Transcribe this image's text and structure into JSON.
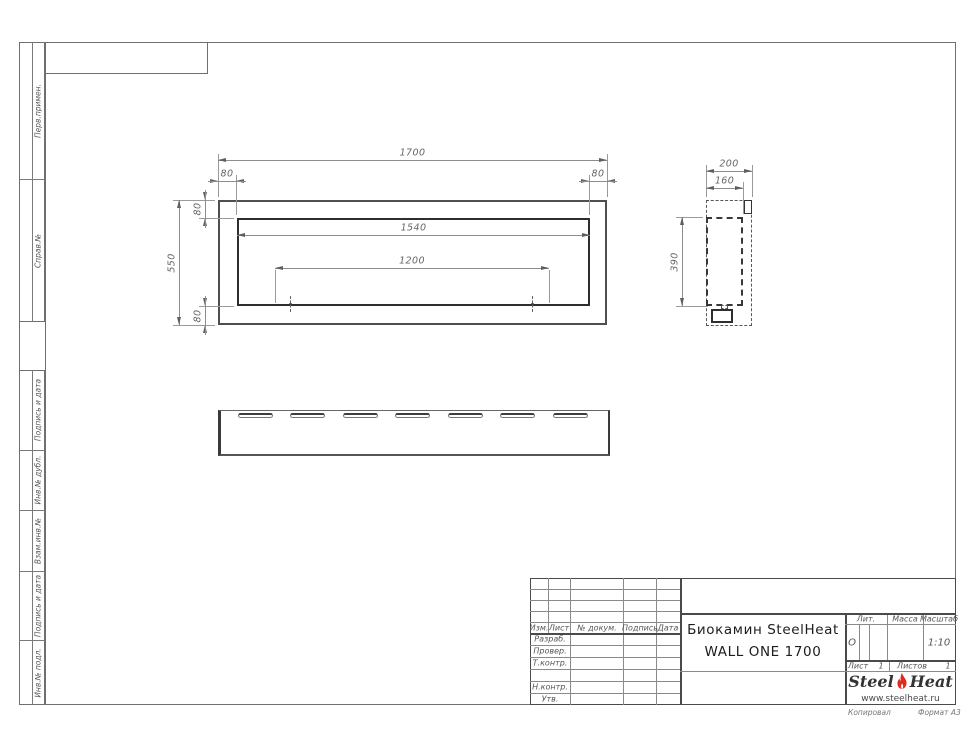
{
  "document": {
    "title_line1": "Биокамин SteelHeat",
    "title_line2": "WALL ONE 1700"
  },
  "stamp": {
    "header": {
      "izm": "Изм.",
      "list": "Лист",
      "doc": "№ докум.",
      "sign": "Подпись",
      "date": "Дата"
    },
    "rows": {
      "razrab": "Разраб.",
      "prover": "Провер.",
      "tkontr": "Т.контр.",
      "nkontr": "Н.контр.",
      "utv": "Утв."
    },
    "right": {
      "lit_label": "Лит.",
      "massa_label": "Масса",
      "scale_label": "Масштаб",
      "lit_value": "О",
      "scale_value": "1:10",
      "sheet_label": "Лист",
      "sheet_value": "1",
      "sheets_label": "Листов",
      "sheets_value": "1"
    }
  },
  "logo": {
    "steel": "Steel",
    "heat": "Heat",
    "site": "www.steelheat.ru",
    "flame_red": "#e02b20",
    "flame_inner": "#ffffff"
  },
  "footer": {
    "copied": "Копировал",
    "format": "Формат А3"
  },
  "margin_groups": [
    {
      "top": 42,
      "height": 280,
      "sections": [
        {
          "label": "Перв.примен.",
          "h": 137
        },
        {
          "label": "Справ.№",
          "h": 143
        }
      ]
    },
    {
      "top": 370,
      "height": 335,
      "sections": [
        {
          "label": "Подпись и дата",
          "h": 80
        },
        {
          "label": "Инв.№ дубл.",
          "h": 60
        },
        {
          "label": "Взам.инв.№",
          "h": 61
        },
        {
          "label": "Подпись и дата",
          "h": 69
        },
        {
          "label": "Инв.№ подл.",
          "h": 65
        }
      ]
    }
  ],
  "drawing": {
    "dimensions_mm": {
      "width": 1700,
      "height": 550,
      "inner_width": 1540,
      "mount_span": 1200,
      "frame": 80,
      "depth": 200,
      "inner_depth": 160,
      "inner_height": 390
    },
    "dimensions": [
      {
        "id": "dim-1700",
        "type": "h",
        "label": "1700",
        "x1": 218,
        "x2": 607,
        "y": 160,
        "arrows": "in"
      },
      {
        "id": "dim-80-top-left",
        "type": "h",
        "label": "80",
        "x1": 218,
        "x2": 236,
        "y": 181,
        "arrows": "out"
      },
      {
        "id": "dim-80-top-right",
        "type": "h",
        "label": "80",
        "x1": 589,
        "x2": 607,
        "y": 181,
        "arrows": "out"
      },
      {
        "id": "dim-1540",
        "type": "h",
        "label": "1540",
        "x1": 237,
        "x2": 590,
        "y": 235,
        "arrows": "in"
      },
      {
        "id": "dim-1200",
        "type": "h",
        "label": "1200",
        "x1": 275,
        "x2": 549,
        "y": 268,
        "arrows": "in"
      },
      {
        "id": "dim-200",
        "type": "h",
        "label": "200",
        "x1": 706,
        "x2": 752,
        "y": 171,
        "arrows": "in"
      },
      {
        "id": "dim-160",
        "type": "h",
        "label": "160",
        "x1": 706,
        "x2": 743,
        "y": 188,
        "arrows": "in"
      },
      {
        "id": "dim-550",
        "type": "v",
        "label": "550",
        "y1": 200,
        "y2": 325,
        "x": 179,
        "arrows": "in"
      },
      {
        "id": "dim-80-left-top",
        "type": "v",
        "label": "80",
        "y1": 200,
        "y2": 218,
        "x": 205,
        "arrows": "out"
      },
      {
        "id": "dim-80-left-bottom",
        "type": "v",
        "label": "80",
        "y1": 306,
        "y2": 325,
        "x": 205,
        "arrows": "out"
      },
      {
        "id": "dim-390",
        "type": "v",
        "label": "390",
        "y1": 217,
        "y2": 306,
        "x": 682,
        "arrows": "in"
      }
    ],
    "ext_lines": [
      {
        "x1": 218,
        "y1": 154,
        "x2": 218,
        "y2": 197
      },
      {
        "x1": 607,
        "y1": 154,
        "x2": 607,
        "y2": 197
      },
      {
        "x1": 236,
        "y1": 175,
        "x2": 236,
        "y2": 215
      },
      {
        "x1": 589,
        "y1": 175,
        "x2": 589,
        "y2": 215
      },
      {
        "x1": 275,
        "y1": 270,
        "x2": 275,
        "y2": 303
      },
      {
        "x1": 549,
        "y1": 270,
        "x2": 549,
        "y2": 303
      },
      {
        "x1": 173,
        "y1": 200,
        "x2": 215,
        "y2": 200
      },
      {
        "x1": 173,
        "y1": 325,
        "x2": 215,
        "y2": 325
      },
      {
        "x1": 199,
        "y1": 218,
        "x2": 234,
        "y2": 218
      },
      {
        "x1": 199,
        "y1": 306,
        "x2": 234,
        "y2": 306
      },
      {
        "x1": 676,
        "y1": 217,
        "x2": 703,
        "y2": 217
      },
      {
        "x1": 676,
        "y1": 306,
        "x2": 708,
        "y2": 306
      },
      {
        "x1": 706,
        "y1": 165,
        "x2": 706,
        "y2": 197
      },
      {
        "x1": 752,
        "y1": 165,
        "x2": 752,
        "y2": 197
      },
      {
        "x1": 743,
        "y1": 182,
        "x2": 743,
        "y2": 214
      }
    ],
    "center_marks": [
      {
        "x": 290,
        "y": 304
      },
      {
        "x": 532,
        "y": 304
      }
    ],
    "bottom_view_slots": {
      "lefts": [
        238,
        290,
        343,
        395,
        448,
        500,
        553
      ],
      "width": 35,
      "height": 5,
      "top": 413
    }
  }
}
